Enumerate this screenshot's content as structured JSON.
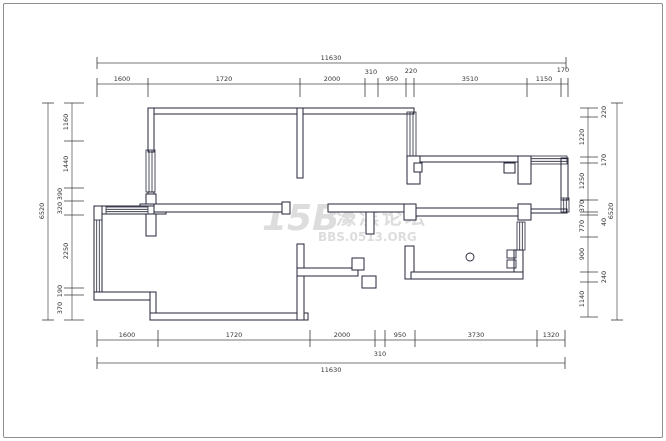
{
  "watermark": {
    "logo": "15B",
    "site_name": "濠滨论坛",
    "url": "BBS.0513.ORG"
  },
  "colors": {
    "wall": "#26263a",
    "dimension_line": "#4a4a4a",
    "dimension_text": "#333333",
    "watermark": "#dadada",
    "background": "#ffffff"
  },
  "dimensions": {
    "top_total": "11630",
    "top_segments": [
      "1600",
      "1720",
      "2000",
      "310",
      "950",
      "220",
      "3510",
      "1150",
      "170"
    ],
    "bottom_segments": [
      "1600",
      "1720",
      "2000",
      "310",
      "950",
      "3730",
      "1320"
    ],
    "bottom_total": "11630",
    "left_total": "6520",
    "left_segments": [
      "1160",
      "1440",
      "390",
      "320",
      "2250",
      "190",
      "370"
    ],
    "right_segments": [
      "220",
      "1220",
      "170",
      "1250",
      "370",
      "40",
      "770",
      "900",
      "240",
      "1140"
    ],
    "right_total": "6520"
  }
}
